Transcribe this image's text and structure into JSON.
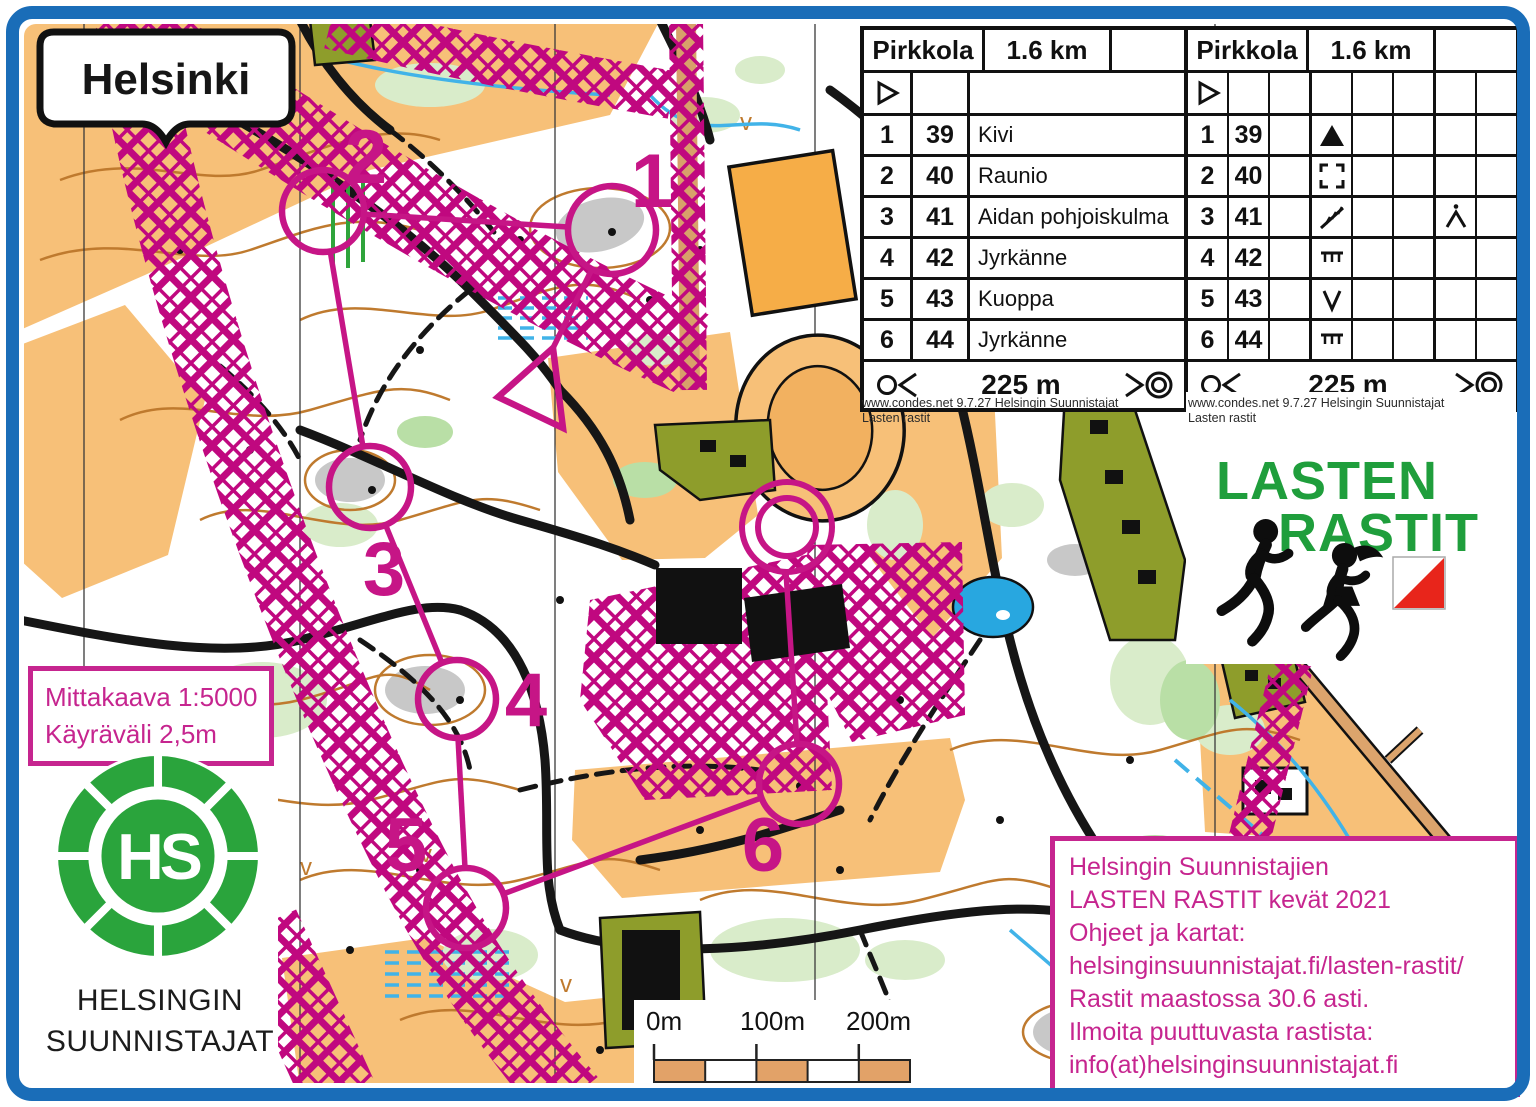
{
  "frame": {
    "border_color": "#1a6db8"
  },
  "map_title_badge": {
    "label": "Helsinki"
  },
  "sheets": {
    "credit_line1": "www.condes.net 9.7.27 Helsingin Suunnistajat",
    "credit_line2": "Lasten rastit",
    "text_sheet": {
      "event": "Pirkkola",
      "distance": "1.6 km",
      "finish_distance": "225 m",
      "rows": [
        {
          "num": "1",
          "code": "39",
          "desc": "Kivi"
        },
        {
          "num": "2",
          "code": "40",
          "desc": "Raunio"
        },
        {
          "num": "3",
          "code": "41",
          "desc": "Aidan pohjoiskulma"
        },
        {
          "num": "4",
          "code": "42",
          "desc": "Jyrkänne"
        },
        {
          "num": "5",
          "code": "43",
          "desc": "Kuoppa"
        },
        {
          "num": "6",
          "code": "44",
          "desc": "Jyrkänne"
        }
      ]
    },
    "symbol_sheet": {
      "event": "Pirkkola",
      "distance": "1.6 km",
      "finish_distance": "225 m",
      "rows": [
        {
          "num": "1",
          "code": "39",
          "col_d": "boulder",
          "col_g": ""
        },
        {
          "num": "2",
          "code": "40",
          "col_d": "ruin",
          "col_g": ""
        },
        {
          "num": "3",
          "code": "41",
          "col_d": "fence",
          "col_g": "corner"
        },
        {
          "num": "4",
          "code": "42",
          "col_d": "cliff",
          "col_g": ""
        },
        {
          "num": "5",
          "code": "43",
          "col_d": "pit",
          "col_g": ""
        },
        {
          "num": "6",
          "code": "44",
          "col_d": "cliff",
          "col_g": ""
        }
      ]
    }
  },
  "course": {
    "color": "#c61586",
    "start": {
      "points": "498,397 553,348 563,428"
    },
    "finish": {
      "x": 787,
      "y": 527,
      "r_outer": 45,
      "r_inner": 29
    },
    "controls": [
      {
        "label": "1",
        "x": 612,
        "y": 230,
        "r": 44,
        "lx": 652,
        "ly": 207
      },
      {
        "label": "2",
        "x": 323,
        "y": 211,
        "r": 41,
        "lx": 366,
        "ly": 183
      },
      {
        "label": "3",
        "x": 370,
        "y": 487,
        "r": 41,
        "lx": 384,
        "ly": 595
      },
      {
        "label": "4",
        "x": 457,
        "y": 699,
        "r": 39,
        "lx": 526,
        "ly": 726
      },
      {
        "label": "5",
        "x": 466,
        "y": 908,
        "r": 40,
        "lx": 406,
        "ly": 871
      },
      {
        "label": "6",
        "x": 799,
        "y": 784,
        "r": 40,
        "lx": 763,
        "ly": 871
      }
    ],
    "legs": [
      {
        "x1": 553,
        "y1": 348,
        "x2": 592,
        "y2": 269
      },
      {
        "x1": 568,
        "y1": 227,
        "x2": 363,
        "y2": 214
      },
      {
        "x1": 330,
        "y1": 250,
        "x2": 363,
        "y2": 447
      },
      {
        "x1": 386,
        "y1": 526,
        "x2": 442,
        "y2": 663
      },
      {
        "x1": 458,
        "y1": 738,
        "x2": 465,
        "y2": 868
      },
      {
        "x1": 503,
        "y1": 894,
        "x2": 761,
        "y2": 798
      },
      {
        "x1": 797,
        "y1": 744,
        "x2": 786,
        "y2": 572
      }
    ]
  },
  "lasten_logo": {
    "line1": "LASTEN",
    "line2": "RASTIT",
    "green": "#1f9e3c",
    "flag_icon": "control-flag"
  },
  "scale_note": {
    "line1": "Mittakaava 1:5000",
    "line2": "Käyräväli 2,5m"
  },
  "club": {
    "name_line1": "HELSINGIN",
    "name_line2": "SUUNNISTAJAT",
    "monogram": "HS",
    "green": "#2aa43c"
  },
  "scale_bar": {
    "labels": [
      "0m",
      "100m",
      "200m"
    ]
  },
  "info_box": {
    "color": "#c6258f",
    "lines": [
      "Helsingin Suunnistajien",
      "LASTEN RASTIT kevät 2021",
      "Ohjeet ja kartat:",
      "helsinginsuunnistajat.fi/lasten-rastit/",
      "Rastit maastossa 30.6 asti.",
      "Ilmoita puuttuvasta rastista:",
      "info(at)helsinginsuunnistajat.fi"
    ]
  }
}
